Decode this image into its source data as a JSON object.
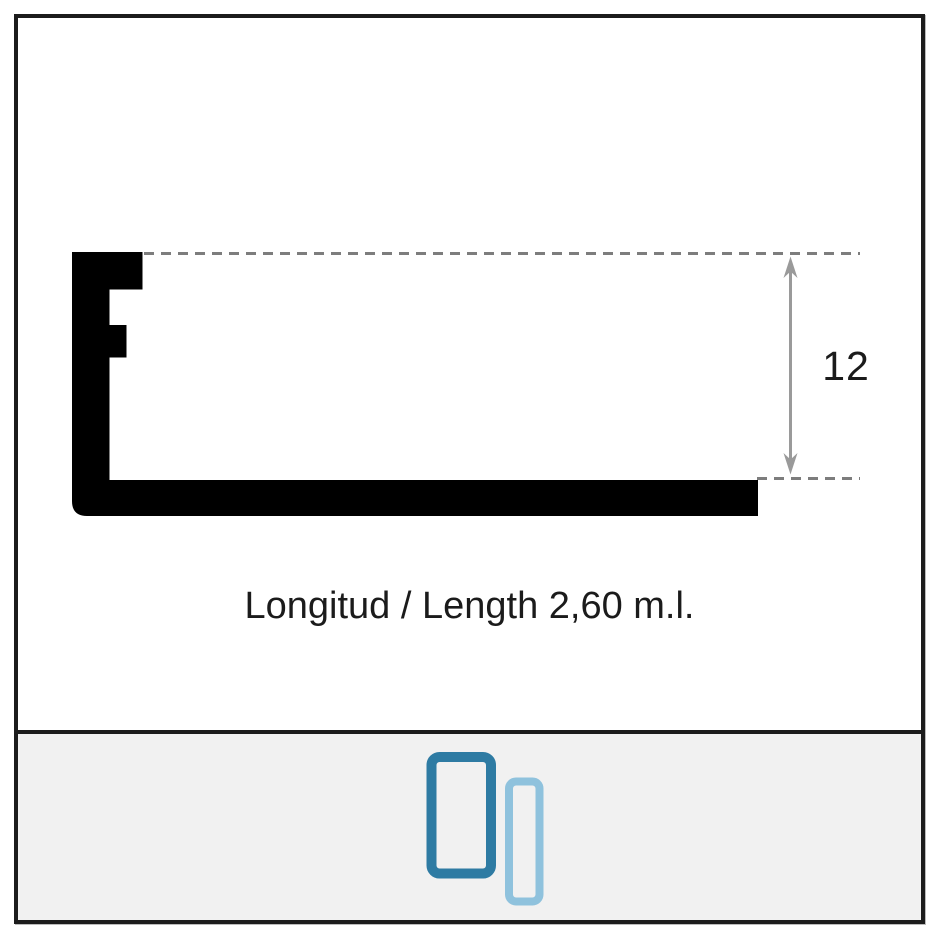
{
  "diagram": {
    "dimension_label": "12",
    "length_label": "Longitud / Length 2,60 m.l."
  },
  "footer": {
    "icons": [
      {
        "name": "profile-orientation-large-icon",
        "color": "#2e7ba3"
      },
      {
        "name": "profile-orientation-small-icon",
        "color": "#8fc2dd"
      }
    ]
  },
  "colors": {
    "profile": "#000000",
    "dashed_line": "#7d7d7d",
    "arrow": "#9a9a9a",
    "frame_border": "#1c1c1c",
    "footer_background": "#f1f1f1",
    "text": "#1b1b1b"
  }
}
